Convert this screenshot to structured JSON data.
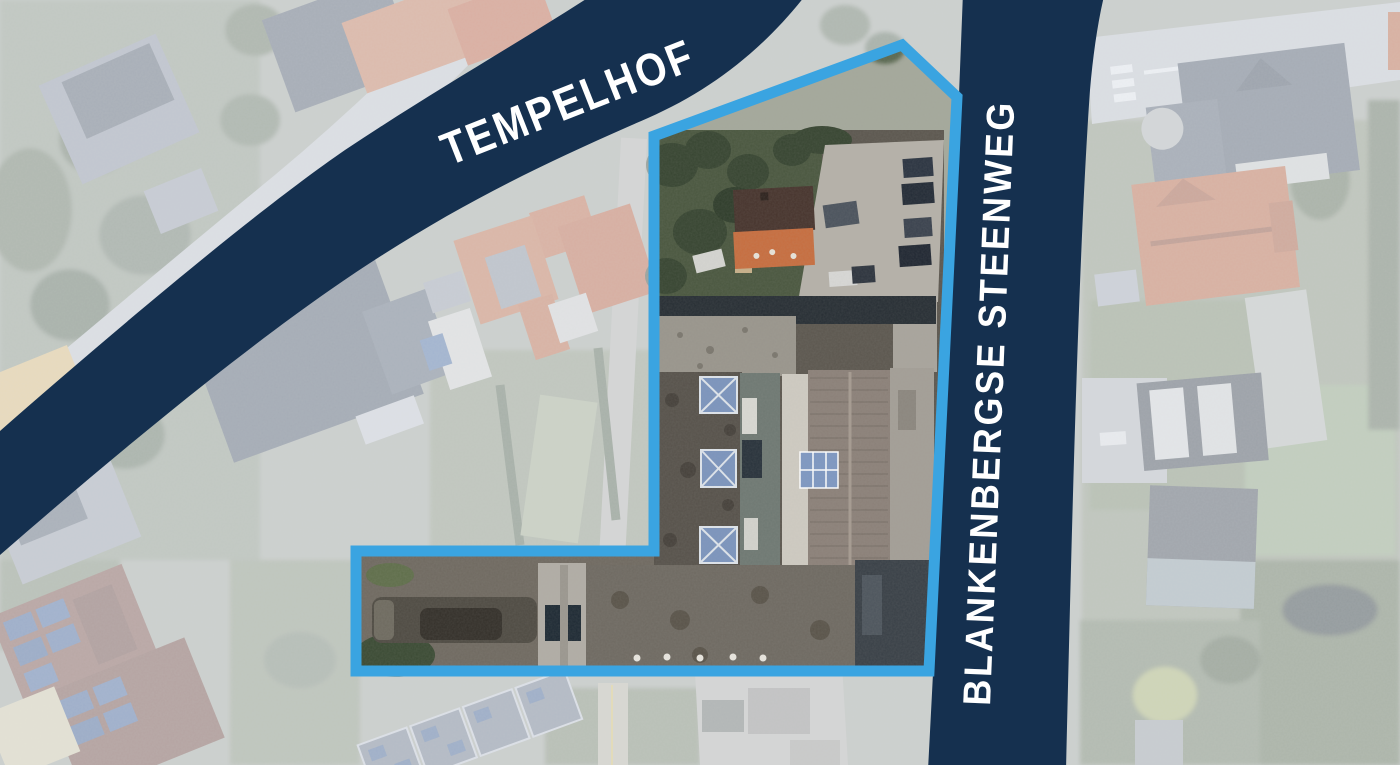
{
  "map": {
    "title": "aerial-site-plan",
    "street_labels": {
      "tempelhof": "TEMPELHOF",
      "blankenbergse_steenweg": "BLANKENBERGSE STEENWEG"
    },
    "colors": {
      "road_band": "#15304f",
      "site_outline": "#3aa4e1",
      "street_label_text": "#ffffff"
    }
  }
}
